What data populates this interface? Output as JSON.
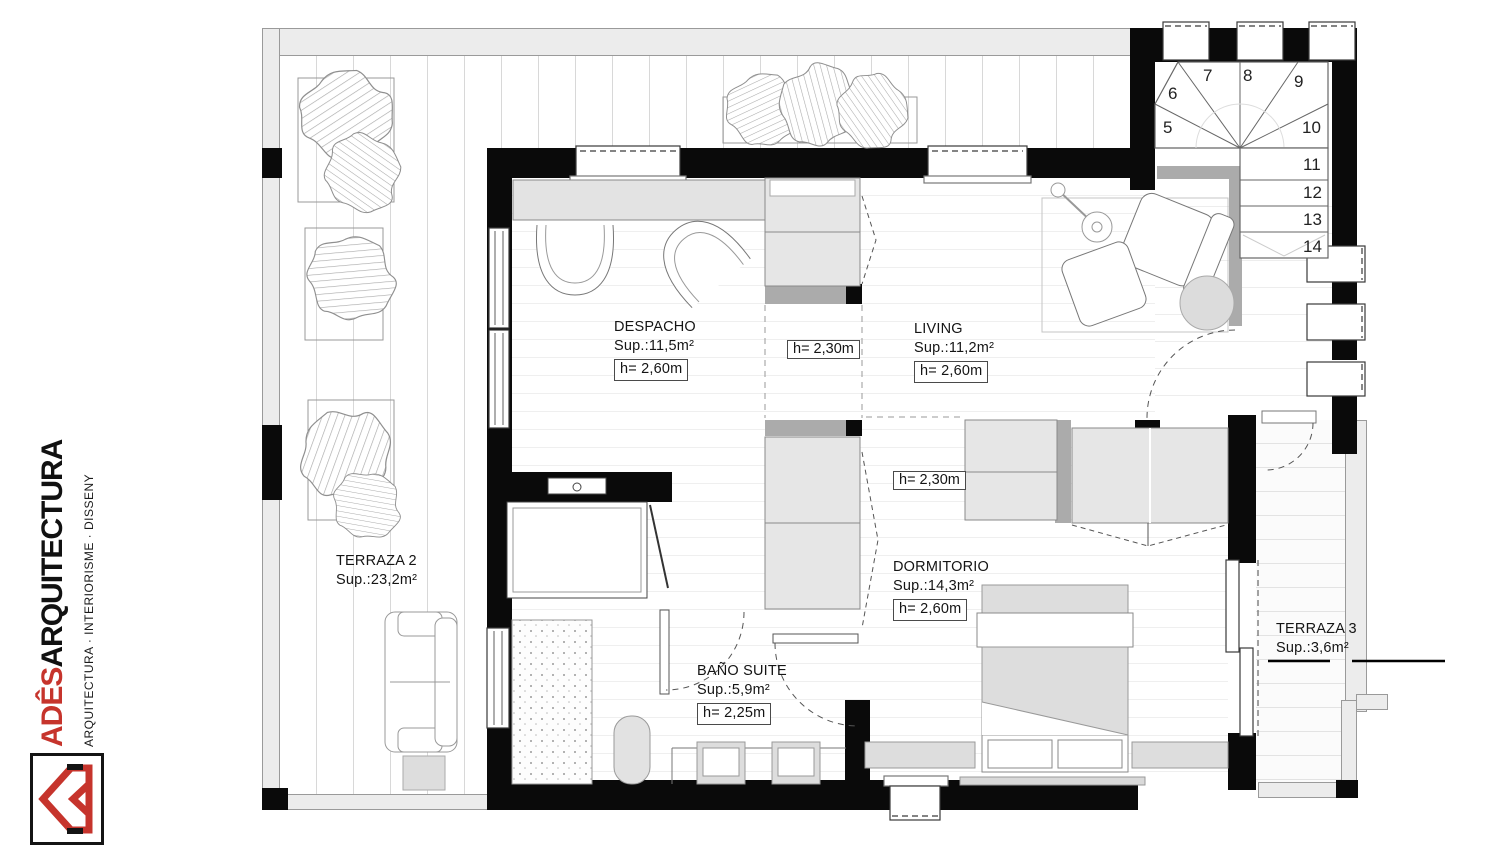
{
  "brand": {
    "name_accent": "ADÊS",
    "name_rest": "ARQUITECTURA",
    "tagline": "ARQUITECTURA · INTERIORISME · DISSENY"
  },
  "rooms": {
    "despacho": {
      "name": "DESPACHO",
      "area": "Sup.:11,5m²",
      "height": "h= 2,60m"
    },
    "living": {
      "name": "LIVING",
      "area": "Sup.:11,2m²",
      "height": "h= 2,60m"
    },
    "dormitorio": {
      "name": "DORMITORIO",
      "area": "Sup.:14,3m²",
      "height": "h= 2,60m"
    },
    "bano": {
      "name": "BAÑO SUITE",
      "area": "Sup.:5,9m²",
      "height": "h= 2,25m"
    },
    "terraza2": {
      "name": "TERRAZA 2",
      "area": "Sup.:23,2m²"
    },
    "terraza3": {
      "name": "TERRAZA 3",
      "area": "Sup.:3,6m²"
    }
  },
  "ceiling_heights": {
    "hall_upper": "h= 2,30m",
    "hall_lower": "h= 2,30m"
  },
  "stairs": {
    "winders": [
      "5",
      "6",
      "7",
      "8",
      "9",
      "10"
    ],
    "flight": [
      "11",
      "12",
      "13",
      "14"
    ]
  },
  "colors": {
    "accent_red": "#c6342c",
    "wall_black": "#0a0a0a",
    "wall_grey": "#ececec",
    "furniture_grey": "#e3e3e3"
  }
}
